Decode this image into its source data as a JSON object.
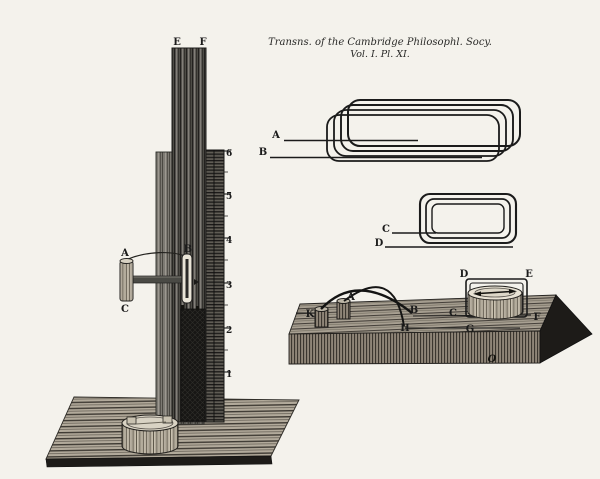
{
  "caption": {
    "line1": "Transns. of the Cambridge Philosophl. Socy.",
    "line2": "Vol. I. Pl. XI."
  },
  "colors": {
    "paper": "#f4f2ec",
    "ink": "#1b1b1b"
  },
  "stand": {
    "label_e": "E",
    "label_f": "F",
    "label_a": "A",
    "label_b": "B",
    "label_c": "C",
    "scale": [
      "6",
      "5",
      "4",
      "3",
      "2",
      "1"
    ]
  },
  "flat_coil": {
    "label_a": "A",
    "label_b": "B"
  },
  "round_coil": {
    "label_c": "C",
    "label_d": "D"
  },
  "board": {
    "label_k": "K",
    "label_a": "A",
    "label_b": "B",
    "label_h": "H",
    "label_c": "C",
    "label_g": "G",
    "label_d": "D",
    "label_e": "E",
    "label_f": "F",
    "label_o": "O"
  }
}
